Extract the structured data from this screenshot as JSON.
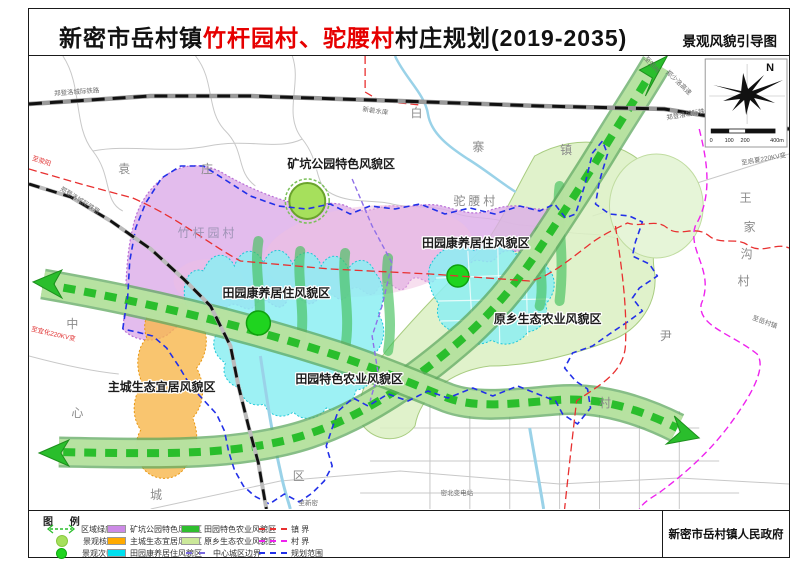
{
  "title": {
    "prefix": "新密市岳村镇",
    "highlight": "竹杆园村、驼腰村",
    "suffix": "村庄规划(2019-2035)",
    "map_type": "景观风貌引导图"
  },
  "publisher": "新密市岳村镇人民政府",
  "compass": {
    "north": "N",
    "scale_ticks": {
      "t0": "0",
      "t1": "100",
      "t2": "200",
      "t3": "400m"
    }
  },
  "legend": {
    "header": "图 例",
    "symbols": [
      {
        "label": "区域绿廊",
        "symbol": "green-dashed-arrow",
        "color": "#2abe2c"
      },
      {
        "label": "景观核心",
        "symbol": "light-green-circle",
        "color": "#a6e05c"
      },
      {
        "label": "景观次中心",
        "symbol": "green-circle",
        "color": "#1fd41f"
      }
    ],
    "zones": [
      {
        "label": "矿坑公园特色风貌区",
        "color": "#cc8ae6"
      },
      {
        "label": "主城生态宜居风貌区",
        "color": "#ffaa00"
      },
      {
        "label": "田园康养居住风貌区",
        "color": "#00e0f0"
      },
      {
        "label": "田园特色农业风貌区",
        "color": "#2ebe2e"
      },
      {
        "label": "原乡生态农业风貌区",
        "color": "#cbe89a"
      },
      {
        "label": "中心城区边界",
        "color": "#7a6ae0",
        "style": "dashed"
      }
    ],
    "lines": [
      {
        "label": "镇 界",
        "color": "#e83030",
        "style": "dashed"
      },
      {
        "label": "村 界",
        "color": "#ee22ee",
        "style": "dashed"
      },
      {
        "label": "规划范围",
        "color": "#2230e8",
        "style": "dashed"
      }
    ]
  },
  "map": {
    "zones": {
      "mine_park": "矿坑公园特色风貌区",
      "kangyang_left": "田园康养居住风貌区",
      "kangyang_right": "田园康养居住风貌区",
      "yuanxiang_agri": "原乡生态农业风貌区",
      "zhucheng_eco": "主城生态宜居风貌区",
      "tianyuan_agri": "田园特色农业风貌区"
    },
    "places": {
      "yuan": "袁",
      "zhuang": "庄",
      "bai": "白",
      "zhai": "寨",
      "zhen": "镇",
      "tuoyao": "驼腰村",
      "zhuganyuan": "竹杆园村",
      "wang": "王",
      "jia": "家",
      "gou": "沟",
      "cun1": "村",
      "yin": "尹",
      "cun2": "村",
      "zhong": "中",
      "xin": "心",
      "cheng": "城",
      "qu": "区",
      "mibei": "密北变电站"
    },
    "roads": {
      "rail1": "郑登洛城际铁路",
      "rail2": "郑登洛城际铁路",
      "rail3": "郑登洛城际铁路",
      "to_zhengzhou": "至郑州",
      "zhengshaoluo": "郑少洛高速",
      "to_xingyang": "至荥阳",
      "to_yihua": "至宜化220KV变",
      "to_qixia": "至启夏220KV变",
      "to_xinmi": "至新密",
      "to_yuecunzhen": "至岳村镇",
      "reservoir": "新砦水库"
    }
  }
}
